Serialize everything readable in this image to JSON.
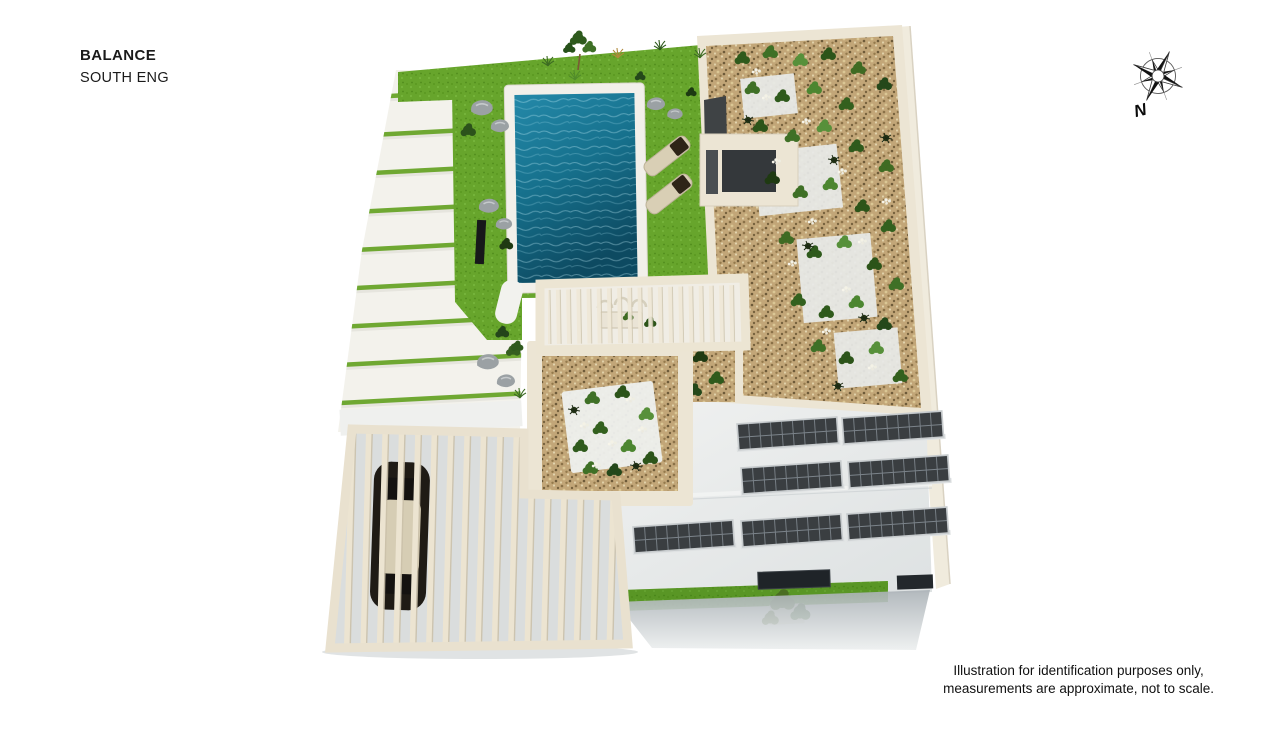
{
  "page": {
    "background": "#ffffff"
  },
  "header": {
    "title": "BALANCE",
    "subtitle": "SOUTH ENG"
  },
  "compass": {
    "label": "N",
    "type": "eight-point-compass-rose"
  },
  "disclaimer": {
    "line1": "Illustration for identification purposes only,",
    "line2": "measurements are approximate, not to scale."
  },
  "illustration": {
    "type": "3d-aerial-site-plan",
    "subject": "Villa plot: striped driveway, pool lawn with loungers, rooftop gravel gardens, dining pergola, solar panel roof, slatted carport with car",
    "features": [
      "striped-driveway",
      "lawn",
      "swimming-pool",
      "sun-loungers",
      "boulders",
      "outdoor-shower",
      "dining-pergola",
      "courtyard-gravel-garden",
      "rooftop-gravel-garden",
      "rooftop-stairwell",
      "solar-panel-roof",
      "carport-pergola",
      "car",
      "south-lawn-strip",
      "tree"
    ],
    "counts": {
      "solar_panels": 7,
      "sun_loungers": 2,
      "cars": 1,
      "driveway_green_stripes": 10
    },
    "colors": {
      "pool_water": "#16708c",
      "pool_water_deep": "#0d4a61",
      "lawn_green": "#67a52c",
      "dark_lawn": "#4f8d1f",
      "gravel_tan": "#c2a678",
      "wall_cream": "#ece5d4",
      "concrete_light": "#eceeee",
      "solar_panel_dark": "#3a3e41",
      "plant_green": "#3f6b23",
      "flower_white": "#f4f2e6",
      "boulder_gray": "#9ba1a4",
      "car_body": "#1f1b15",
      "text_black": "#1a1a1a"
    }
  }
}
